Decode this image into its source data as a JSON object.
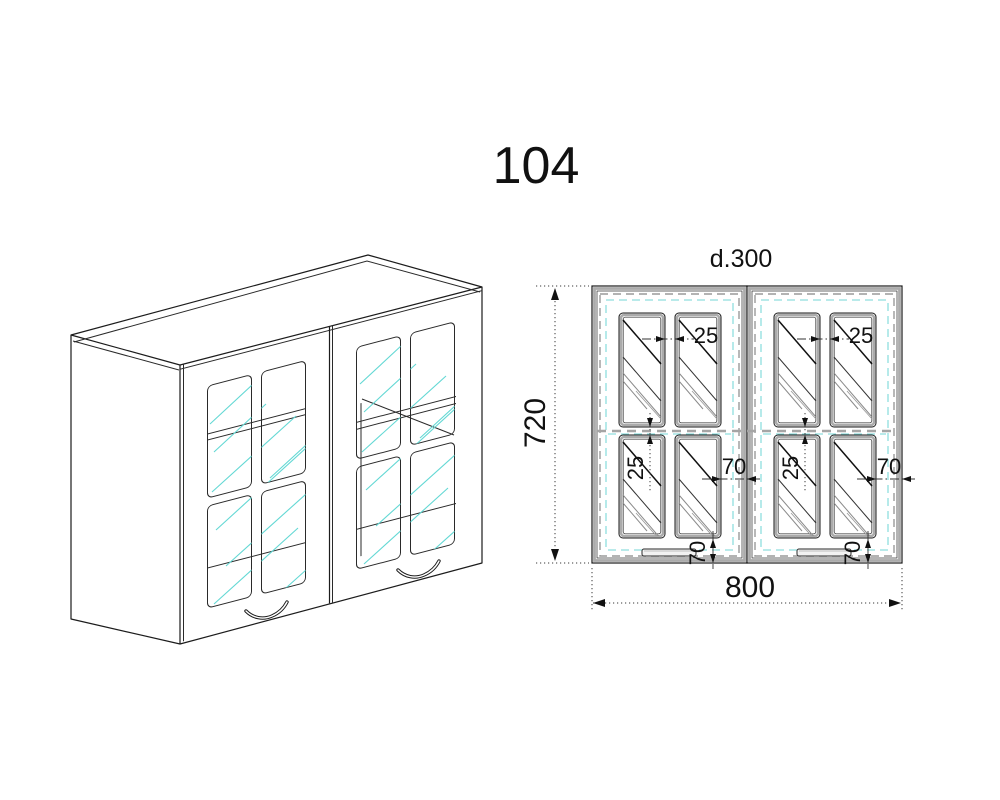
{
  "drawing": {
    "title": "104",
    "front_view": {
      "depth_label": "d.300",
      "height_mm": "720",
      "width_mm": "800",
      "muntin_gap_mm": "25",
      "frame_margin_mm": "70"
    }
  },
  "colors": {
    "line": "#1c1c1c",
    "frame_gray": "#ababab",
    "dash_gray": "#9a9a9a",
    "glass_cyan": "#63d8d4",
    "dash_cyan": "#8fdede",
    "paper": "#ffffff"
  }
}
